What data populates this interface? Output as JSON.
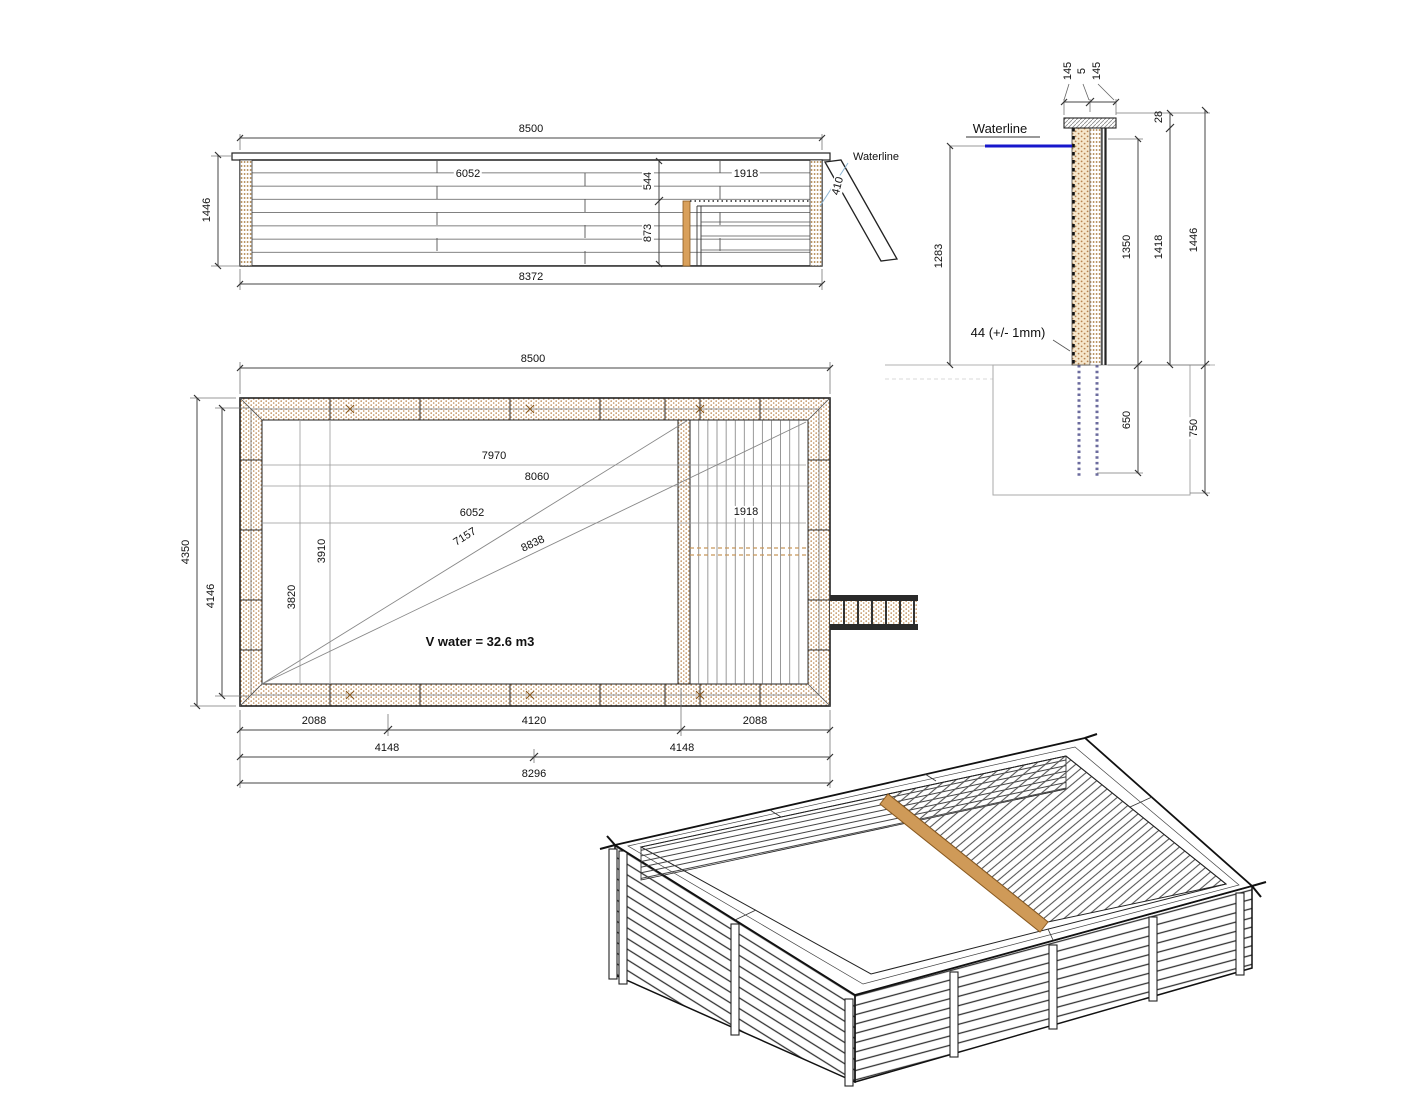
{
  "elevation": {
    "dim_top": "8500",
    "dim_height": "1446",
    "dim_bottom": "8372",
    "dim_inner_length": "6052",
    "dim_deck_drop": "544",
    "dim_deck_length": "1918",
    "dim_below_deck": "873",
    "dim_ladder": "410",
    "waterline_label": "Waterline"
  },
  "section": {
    "dim_wall_outer": "145",
    "dim_wall_gap": "5",
    "dim_wall_inner": "145",
    "dim_cap": "28",
    "waterline_label": "Waterline",
    "dim_water_height": "1283",
    "plank_note": "44 (+/- 1mm)",
    "dim_inner_height": "1350",
    "dim_wall_height": "1418",
    "dim_total_height": "1446",
    "dim_underground": "650",
    "dim_foundation": "750"
  },
  "plan": {
    "dim_top": "8500",
    "dim_width_outer": "4350",
    "dim_width_inner": "4146",
    "dim_7970": "7970",
    "dim_8060": "8060",
    "dim_6052": "6052",
    "dim_diag_swim": "7157",
    "dim_diag_full": "8838",
    "dim_deck": "1918",
    "dim_3910": "3910",
    "dim_3820": "3820",
    "volume_label": "V water = 32.6 m3",
    "dim_2088_left": "2088",
    "dim_4120": "4120",
    "dim_2088_right": "2088",
    "dim_4148_left": "4148",
    "dim_4148_right": "4148",
    "dim_8296": "8296"
  },
  "colors": {
    "waterline_blue": "#1717cc",
    "wood_orange": "#cf9a58",
    "underground_dots": "#6b6b9e"
  }
}
